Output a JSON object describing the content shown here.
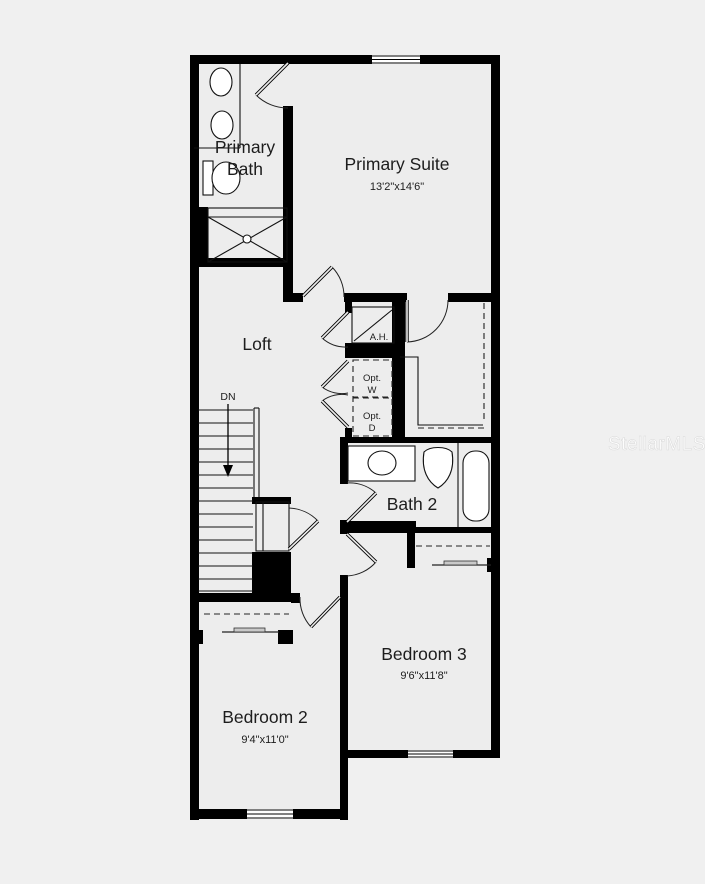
{
  "watermark": "StellarMLS",
  "rooms": {
    "primary_bath": {
      "line1": "Primary",
      "line2": "Bath"
    },
    "primary_suite": {
      "name": "Primary Suite",
      "dims": "13'2\"x14'6\""
    },
    "loft": {
      "name": "Loft"
    },
    "bath_2": {
      "name": "Bath 2"
    },
    "bedroom_2": {
      "name": "Bedroom 2",
      "dims": "9'4\"x11'0\""
    },
    "bedroom_3": {
      "name": "Bedroom 3",
      "dims": "9'6\"x11'8\""
    }
  },
  "labels": {
    "stair_direction": "DN",
    "air_handler": "A.H.",
    "optional_washer": {
      "line1": "Opt.",
      "line2": "W"
    },
    "optional_dryer": {
      "line1": "Opt.",
      "line2": "D"
    }
  },
  "colors": {
    "wall": "#000000",
    "floor": "#ededed",
    "background": "#f0f0f0",
    "watermark": "#ffffff"
  }
}
